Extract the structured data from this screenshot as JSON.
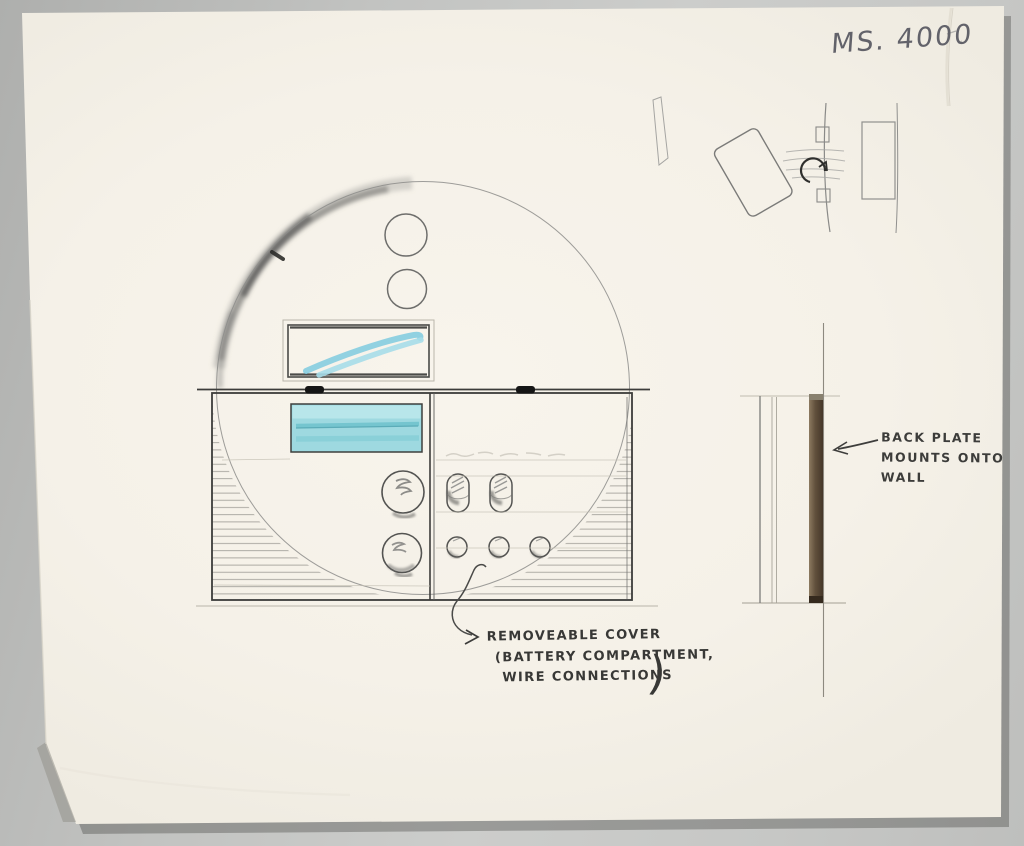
{
  "sheet": {
    "model_number": "MS. 4000",
    "annotations": {
      "back_plate": {
        "line1": "BACK PLATE",
        "line2": "MOUNTS ONTO",
        "line3": "WALL"
      },
      "removable_cover": {
        "line1": "REMOVEABLE COVER",
        "line2": "(BATTERY COMPARTMENT,",
        "line3": "WIRE CONNECTIONS",
        "close_paren": ")"
      }
    },
    "colors": {
      "paper": "#f5f1e8",
      "background_gray": "#c2c3c1",
      "pencil": "#5a5a58",
      "ink_clip_black": "#151515",
      "accent_blue": "#9ed9e0",
      "accent_blue_dark": "#6fc2cd",
      "back_plate_brown": "#61503c"
    }
  }
}
